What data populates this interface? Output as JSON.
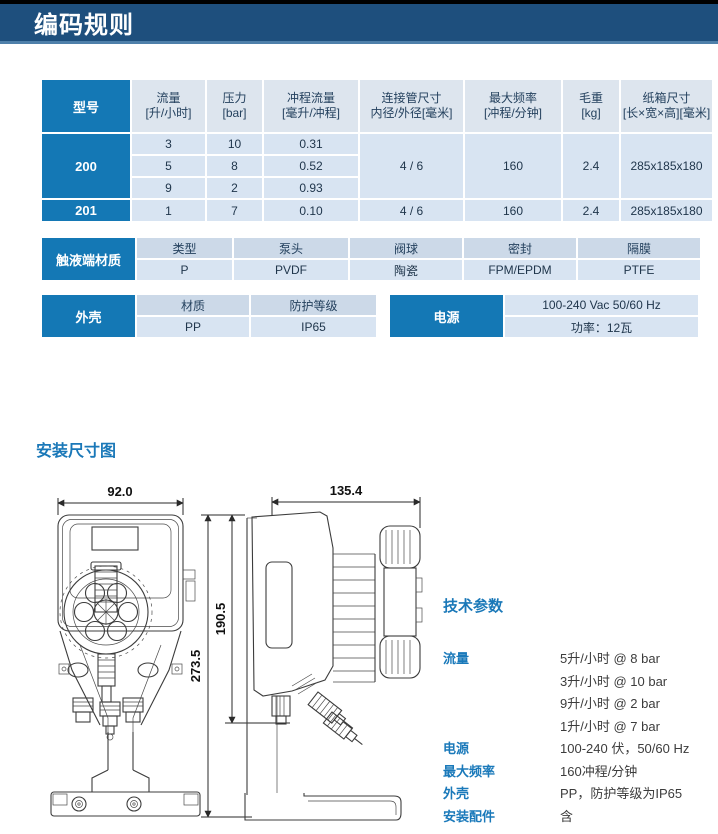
{
  "header": {
    "title": "编码规则"
  },
  "colors": {
    "header_navy": "#1e4f7d",
    "header_underline": "#4f80aa",
    "accent_blue": "#1478b5",
    "table_header_bg": "#dde5ee",
    "table_cell_bg": "#d8e4f2",
    "subheader_bg": "#ccd9e8",
    "label_blue": "#1a78b8"
  },
  "spec_table": {
    "headers": [
      {
        "label": "型号",
        "unit": ""
      },
      {
        "label": "流量",
        "unit": "[升/小时]"
      },
      {
        "label": "压力",
        "unit": "[bar]"
      },
      {
        "label": "冲程流量",
        "unit": "[毫升/冲程]"
      },
      {
        "label": "连接管尺寸",
        "unit": "内径/外径[毫米]"
      },
      {
        "label": "最大频率",
        "unit": "[冲程/分钟]"
      },
      {
        "label": "毛重",
        "unit": "[kg]"
      },
      {
        "label": "纸箱尺寸",
        "unit": "[长×宽×高][毫米]"
      }
    ],
    "model_200": {
      "model": "200",
      "sub_rows": [
        {
          "flow": "3",
          "pressure": "10",
          "stroke_flow": "0.31"
        },
        {
          "flow": "5",
          "pressure": "8",
          "stroke_flow": "0.52"
        },
        {
          "flow": "9",
          "pressure": "2",
          "stroke_flow": "0.93"
        }
      ],
      "pipe_size": "4 / 6",
      "max_freq": "160",
      "weight": "2.4",
      "carton": "285x185x180"
    },
    "model_201": {
      "model": "201",
      "flow": "1",
      "pressure": "7",
      "stroke_flow": "0.10",
      "pipe_size": "4 / 6",
      "max_freq": "160",
      "weight": "2.4",
      "carton": "285x185x180"
    }
  },
  "material_table": {
    "label": "触液端材质",
    "columns": [
      {
        "header": "类型",
        "value": "P"
      },
      {
        "header": "泵头",
        "value": "PVDF"
      },
      {
        "header": "阀球",
        "value": "陶瓷"
      },
      {
        "header": "密封",
        "value": "FPM/EPDM"
      },
      {
        "header": "隔膜",
        "value": "PTFE"
      }
    ]
  },
  "housing_table": {
    "label": "外壳",
    "columns": [
      {
        "header": "材质",
        "value": "PP"
      },
      {
        "header": "防护等级",
        "value": "IP65"
      }
    ]
  },
  "power_table": {
    "label": "电源",
    "line1": "100-240 Vac 50/60 Hz",
    "line2": "功率：12瓦"
  },
  "install_section": {
    "title": "安装尺寸图",
    "dims": {
      "front_width": "92.0",
      "side_width": "135.4",
      "total_height": "273.5",
      "upper_height": "190.5"
    }
  },
  "tech_params": {
    "title": "技术参数",
    "flow": {
      "label": "流量",
      "values": [
        "5升/小时 @ 8 bar",
        "3升/小时 @ 10 bar",
        "9升/小时 @ 2 bar",
        "1升/小时 @ 7 bar"
      ]
    },
    "rows": [
      {
        "label": "电源",
        "value": "100-240 伏，50/60 Hz"
      },
      {
        "label": "最大频率",
        "value": "160冲程/分钟"
      },
      {
        "label": "外壳",
        "value": "PP，防护等级为IP65"
      },
      {
        "label": "安装配件",
        "value": "含"
      }
    ]
  }
}
